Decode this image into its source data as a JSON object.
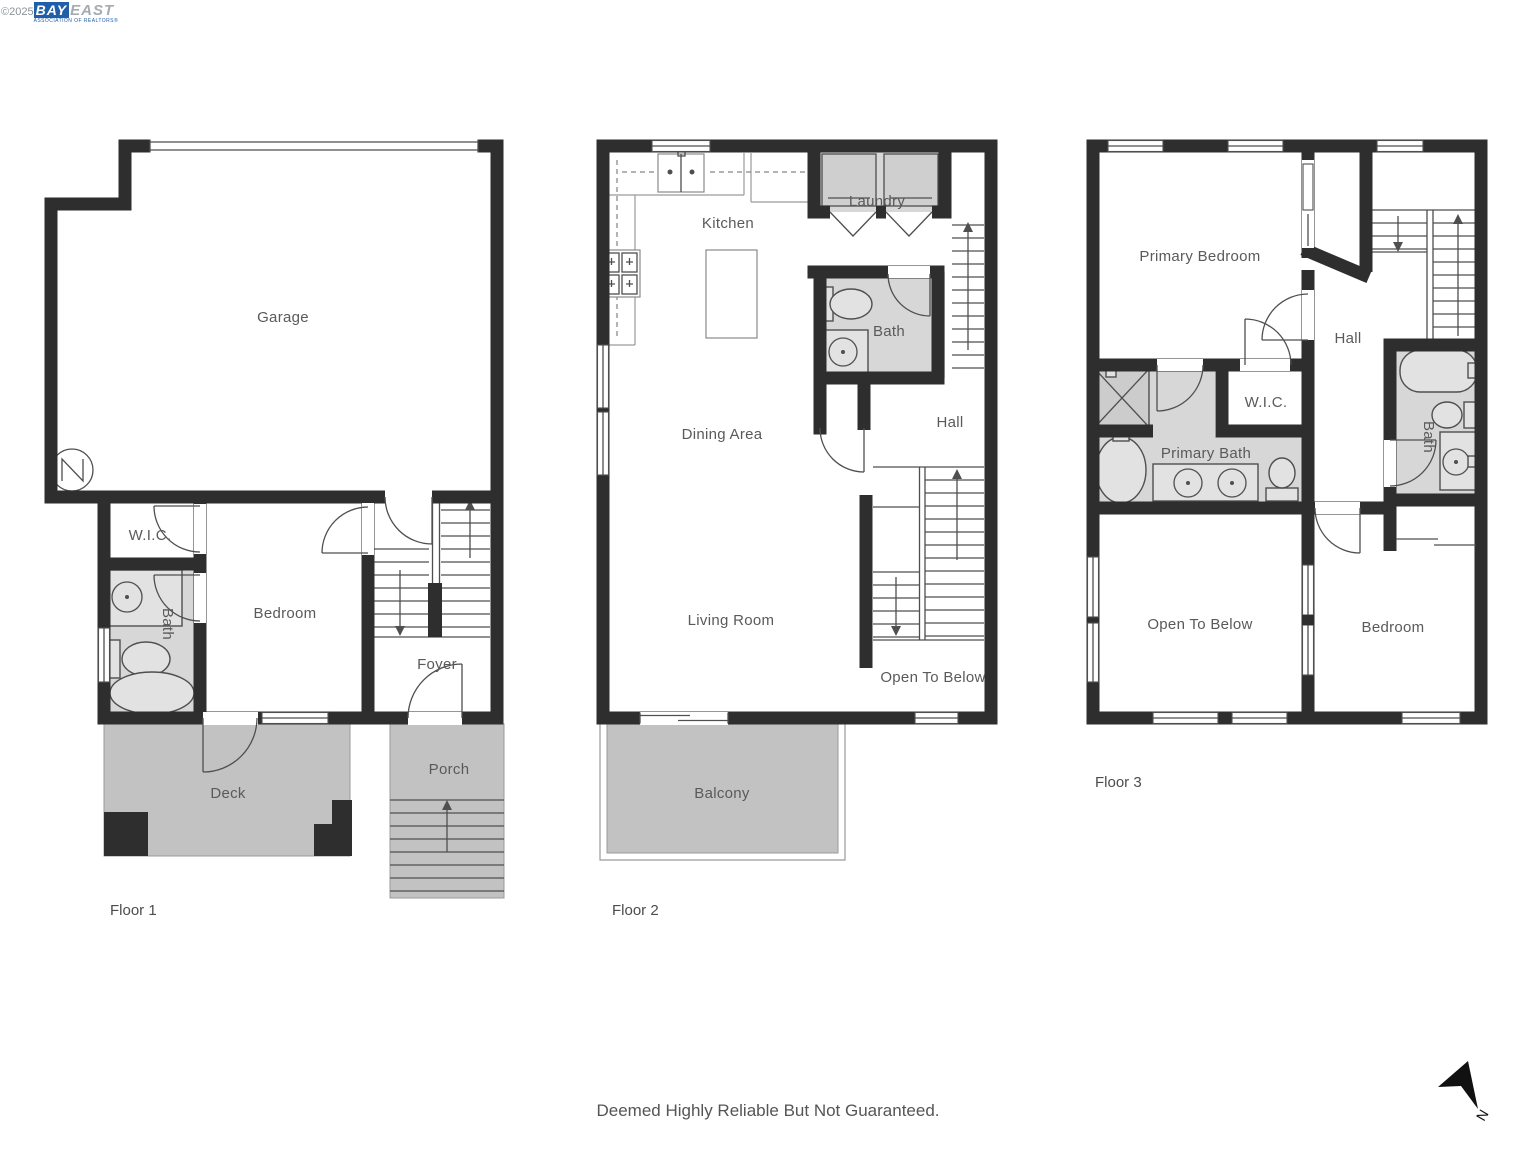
{
  "branding": {
    "copyright": "©2025",
    "logo_primary": "BAY",
    "logo_secondary": "EAST",
    "logo_tagline": "ASSOCIATION OF REALTORS®"
  },
  "floors": [
    {
      "label": "Floor 1",
      "rooms": {
        "garage": "Garage",
        "wic": "W.I.C.",
        "bath": "Bath",
        "bedroom": "Bedroom",
        "foyer": "Foyer",
        "deck": "Deck",
        "porch": "Porch"
      }
    },
    {
      "label": "Floor 2",
      "rooms": {
        "kitchen": "Kitchen",
        "laundry": "Laundry",
        "bath": "Bath",
        "hall": "Hall",
        "dining": "Dining Area",
        "living": "Living Room",
        "open_to_below": "Open To Below",
        "balcony": "Balcony"
      }
    },
    {
      "label": "Floor 3",
      "rooms": {
        "primary_bedroom": "Primary Bedroom",
        "hall": "Hall",
        "wic": "W.I.C.",
        "primary_bath": "Primary Bath",
        "bath": "Bath",
        "open_to_below": "Open To Below",
        "bedroom": "Bedroom"
      }
    }
  ],
  "compass": {
    "north_label": "N"
  },
  "footer": {
    "disclaimer": "Deemed Highly Reliable But Not Guaranteed."
  },
  "colors": {
    "wall": "#2e2e2e",
    "interior_gray": "#d7d7d7",
    "outdoor_gray": "#c2c2c2",
    "line": "#4f4f4f",
    "label_text": "#5a5a5a",
    "logo_blue": "#1f5ea9",
    "logo_gray": "#a6abb1"
  }
}
